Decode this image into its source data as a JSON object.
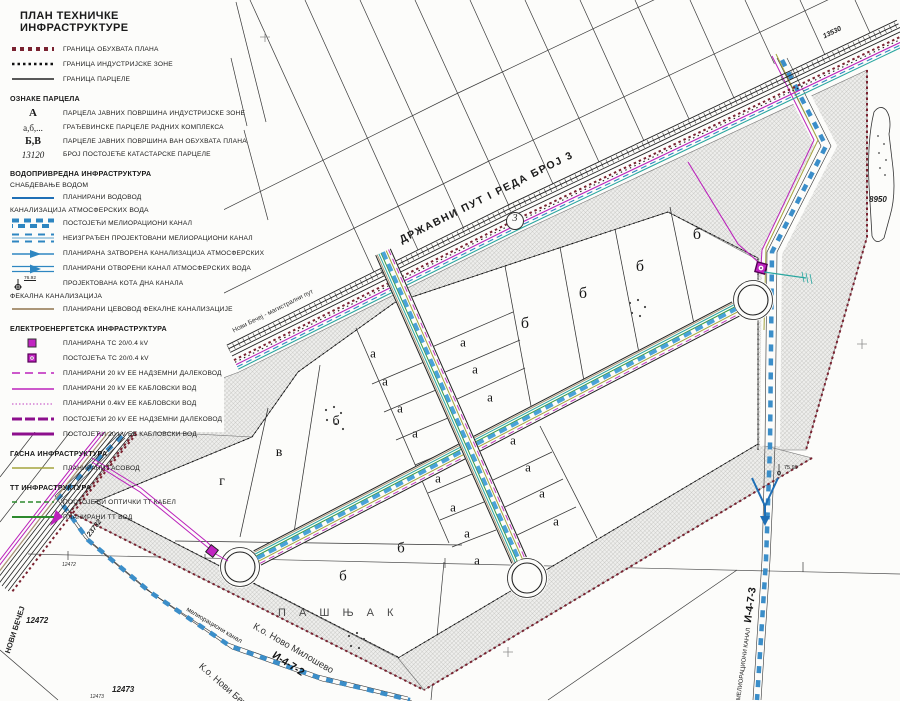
{
  "legend": {
    "title": "ПЛАН ТЕХНИЧКЕ ИНФРАСТРУКТУРЕ",
    "boundaries": [
      "ГРАНИЦА ОБУХВАТА ПЛАНА",
      "ГРАНИЦА ИНДУСТРИЈСКЕ ЗОНЕ",
      "ГРАНИЦА ПАРЦЕЛЕ"
    ],
    "oznake": {
      "heading": "ОЗНАКЕ ПАРЦЕЛА",
      "rows": [
        {
          "sym": "А",
          "label": "ПАРЦЕЛА ЈАВНИХ ПОВРШИНА ИНДУСТРИЈСКЕ ЗОНЕ"
        },
        {
          "sym": "а,б,...",
          "label": "ГРАЂЕВИНСКЕ ПАРЦЕЛЕ РАДНИХ КОМПЛЕКСА"
        },
        {
          "sym": "Б,В",
          "label": "ПАРЦЕЛЕ ЈАВНИХ ПОВРШИНА ВАН ОБУХВАТА ПЛАНА"
        },
        {
          "sym": "13120",
          "label": "БРОЈ ПОСТОЈЕЋЕ КАТАСТАРСКЕ ПАРЦЕЛЕ"
        }
      ]
    },
    "vodo": {
      "heading": "ВОДОПРИВРЕДНА ИНФРАСТРУКТУРА",
      "sub_water": "СНАБДЕВАЊЕ ВОДОМ",
      "water_row": "ПЛАНИРАНИ ВОДОВОД",
      "sub_storm": "КАНАЛИЗАЦИЈА АТМОСФЕРСКИХ ВОДА",
      "storm_rows": [
        "ПОСТОЈЕЋИ МЕЛИОРАЦИОНИ КАНАЛ",
        "НЕИЗГРАЂЕН ПРОЈЕКТОВАНИ МЕЛИОРАЦИОНИ КАНАЛ",
        "ПЛАНИРАНА ЗАТВОРЕНА КАНАЛИЗАЦИЈА АТМОСФЕРСКИХ",
        "ПЛАНИРАНИ ОТВОРЕНИ КАНАЛ АТМОСФЕРСКИХ ВОДА"
      ],
      "kota_label": "ПРОЈЕКТОВАНА КОТА ДНА КАНАЛА",
      "kota_value": "76.92",
      "sub_fecal": "ФЕКАЛНА КАНАЛИЗАЦИЈА",
      "fecal_row": "ПЛАНИРАНИ ЦЕВОВОД ФЕКАЛНЕ КАНАЛИЗАЦИЈЕ"
    },
    "elektro": {
      "heading": "ЕЛЕКТРОЕНЕРГЕТСКА ИНФРАСТРУКТУРА",
      "rows": [
        "ПЛАНИРАНА ТС 20/0.4 kV",
        "ПОСТОЈЕЋА ТС 20/0.4 kV",
        "ПЛАНИРАНИ 20 kV ЕЕ НАДЗЕМНИ ДАЛЕКОВОД",
        "ПЛАНИРАНИ 20 kV ЕЕ КАБЛОВСКИ ВОД",
        "ПЛАНИРАНИ 0.4kV ЕЕ КАБЛОВСКИ ВОД",
        "ПОСТОЈЕЋИ 20 kV ЕЕ НАДЗЕМНИ ДАЛЕКОВОД",
        "ПОСТОЈЕЋИ 20 kV ЕЕ КАБЛОВСКИ ВОД"
      ]
    },
    "gas": {
      "heading": "ГАСНА ИНФРАСТРУКТУРА",
      "rows": [
        "ПЛАНИРАНИ ГАСОВОД"
      ]
    },
    "tt": {
      "heading": "ТТ ИНФРАСТРУКТУРА",
      "rows": [
        "ПОСТОЈЕЋИ ОПТИЧКИ ТТ КАБЕЛ",
        "ПЛАНИРАНИ ТТ ВОД"
      ]
    }
  },
  "colors": {
    "water": "#2e86c1",
    "power_planned": "#bb22bb",
    "power_existing": "#8d0f8d",
    "gas": "#a3a33c",
    "tt": "#2d8a2d",
    "fecal": "#ab9678",
    "plan_boundary": "#7a2230",
    "ts_fill": "#c124c1",
    "paper": "#fcfcfa"
  },
  "map": {
    "road_badge": "3",
    "annotations": [
      {
        "t": "ДРЖАВНИ ПУТ I РЕДА БРОЈ 3",
        "x": 398,
        "y": 236,
        "r": -26.5,
        "s": 10.5,
        "w": 600,
        "ls": 1.5,
        "c": "#1a1a1a"
      },
      {
        "t": "Нови Бечеј - магистрални пут",
        "x": 232,
        "y": 329,
        "r": -26.5,
        "s": 6.5,
        "c": "#333333"
      },
      {
        "t": "13530",
        "x": 822,
        "y": 34,
        "r": -26,
        "s": 7,
        "i": 1,
        "w": 700,
        "c": "#222222"
      },
      {
        "t": "8950",
        "x": 869,
        "y": 196,
        "r": 0,
        "s": 8,
        "i": 1,
        "w": 700,
        "c": "#222222"
      },
      {
        "t": "23732",
        "x": 86,
        "y": 534,
        "r": -53,
        "s": 7,
        "i": 1,
        "w": 700,
        "c": "#222222"
      },
      {
        "t": "НОВИ БЕЧЕЈ",
        "x": 4,
        "y": 652,
        "r": -72,
        "s": 7.5,
        "w": 700,
        "c": "#222222"
      },
      {
        "t": "12472",
        "x": 62,
        "y": 563,
        "r": 0,
        "s": 5,
        "i": 1,
        "c": "#333333"
      },
      {
        "t": "12472",
        "x": 26,
        "y": 617,
        "r": 0,
        "s": 8,
        "i": 1,
        "w": 700,
        "c": "#222222"
      },
      {
        "t": "12473",
        "x": 112,
        "y": 686,
        "r": 0,
        "s": 8,
        "i": 1,
        "w": 700,
        "c": "#222222"
      },
      {
        "t": "12473",
        "x": 90,
        "y": 695,
        "r": 0,
        "s": 5,
        "i": 1,
        "c": "#333333"
      },
      {
        "t": "П А Ш Њ А К",
        "x": 278,
        "y": 608,
        "r": 0,
        "s": 11,
        "ls": 5,
        "c": "#4a4a4a"
      },
      {
        "t": "К.о. Ново Милошево",
        "x": 256,
        "y": 622,
        "r": 30,
        "s": 9.5,
        "c": "#333333"
      },
      {
        "t": "мелиорациони канал",
        "x": 188,
        "y": 607,
        "r": 31,
        "s": 6.5,
        "c": "#222222"
      },
      {
        "t": "И-4-7-2",
        "x": 276,
        "y": 650,
        "r": 33,
        "s": 10.5,
        "w": 700,
        "c": "#111111"
      },
      {
        "t": "К.о. Нови Бечеј",
        "x": 203,
        "y": 662,
        "r": 41,
        "s": 9.5,
        "c": "#333333"
      },
      {
        "t": "И-4-7-3",
        "x": 743,
        "y": 622,
        "r": -82,
        "s": 10.5,
        "w": 700,
        "c": "#111111"
      },
      {
        "t": "МЕЛИОРАЦИОНИ КАНАЛ",
        "x": 736,
        "y": 700,
        "r": -82,
        "s": 6,
        "c": "#222222"
      },
      {
        "t": "75.99",
        "x": 784,
        "y": 466,
        "r": 0,
        "s": 5.5,
        "c": "#222222"
      }
    ],
    "parcel_labels": [
      {
        "t": "г",
        "x": 222,
        "y": 482,
        "s": 14
      },
      {
        "t": "в",
        "x": 279,
        "y": 453,
        "s": 14
      },
      {
        "t": "б",
        "x": 336,
        "y": 422,
        "s": 14
      },
      {
        "t": "а",
        "x": 373,
        "y": 353
      },
      {
        "t": "а",
        "x": 385,
        "y": 381
      },
      {
        "t": "а",
        "x": 400,
        "y": 408
      },
      {
        "t": "а",
        "x": 415,
        "y": 433
      },
      {
        "t": "а",
        "x": 463,
        "y": 342
      },
      {
        "t": "а",
        "x": 475,
        "y": 369
      },
      {
        "t": "а",
        "x": 490,
        "y": 397
      },
      {
        "t": "б",
        "x": 525,
        "y": 324,
        "s": 16
      },
      {
        "t": "б",
        "x": 583,
        "y": 294,
        "s": 16
      },
      {
        "t": "б",
        "x": 640,
        "y": 267,
        "s": 16
      },
      {
        "t": "б",
        "x": 697,
        "y": 235,
        "s": 16
      },
      {
        "t": "а",
        "x": 513,
        "y": 440
      },
      {
        "t": "а",
        "x": 528,
        "y": 467
      },
      {
        "t": "а",
        "x": 542,
        "y": 493
      },
      {
        "t": "а",
        "x": 556,
        "y": 521
      },
      {
        "t": "а",
        "x": 438,
        "y": 478
      },
      {
        "t": "а",
        "x": 453,
        "y": 507
      },
      {
        "t": "а",
        "x": 467,
        "y": 533
      },
      {
        "t": "а",
        "x": 477,
        "y": 560
      },
      {
        "t": "б",
        "x": 401,
        "y": 549,
        "s": 15
      },
      {
        "t": "б",
        "x": 343,
        "y": 577,
        "s": 15
      }
    ]
  }
}
